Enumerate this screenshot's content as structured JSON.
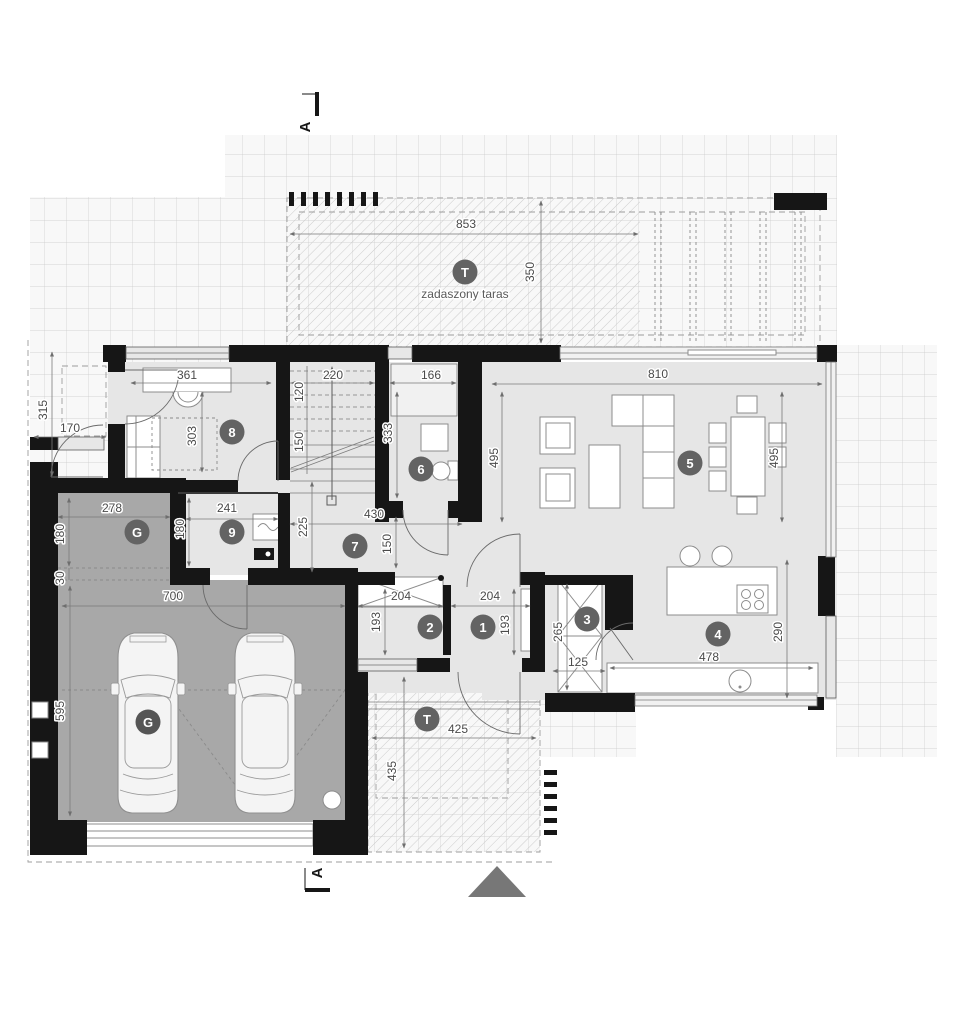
{
  "section": {
    "top": "A",
    "bottom": "A"
  },
  "terrace_top": {
    "badge": "T",
    "label": "zadaszony taras",
    "dim_w": "853",
    "dim_d": "350"
  },
  "terrace_bottom": {
    "badge": "T",
    "dim_w": "425",
    "dim_d": "435"
  },
  "porch": {
    "dim_w": "170",
    "dim_d": "315"
  },
  "rooms": {
    "r1": {
      "badge": "1",
      "dim_w": "204",
      "dim_d": "193"
    },
    "r2": {
      "badge": "2",
      "dim_w": "204",
      "dim_d": "193"
    },
    "r3": {
      "badge": "3",
      "dim_w": "125",
      "dim_d": "265"
    },
    "r4": {
      "badge": "4",
      "dim_w": "478",
      "dim_d": "290"
    },
    "r5": {
      "badge": "5",
      "dim_w": "810",
      "dim_d_left": "495",
      "dim_d_right": "495"
    },
    "r6": {
      "badge": "6",
      "dim_w": "166",
      "dim_d": "333"
    },
    "r7": {
      "badge": "7",
      "dim_w": "430",
      "dim_d": "225",
      "dim_door": "150"
    },
    "r8": {
      "badge": "8",
      "dim_w": "361",
      "dim_d": "303"
    },
    "r9": {
      "badge": "9",
      "dim_w": "241",
      "dim_d": "180"
    },
    "utility": {
      "badge": "G",
      "dim_w": "278",
      "dim_d": "180",
      "dim_step": "30"
    },
    "garage": {
      "badge": "G",
      "dim_w": "700",
      "dim_d": "595"
    },
    "stairs": {
      "dim_w": "220",
      "dim_d1": "120",
      "dim_d2": "150"
    }
  }
}
